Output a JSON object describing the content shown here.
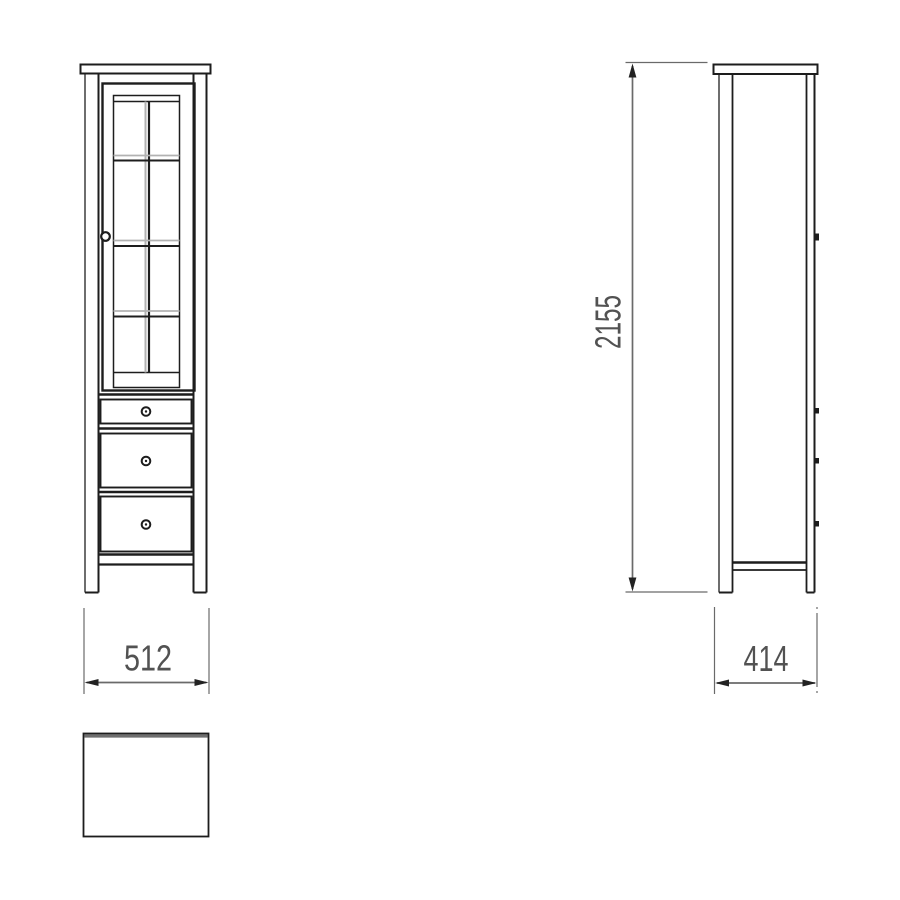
{
  "drawing": {
    "kind": "furniture-orthographic-views",
    "views": {
      "front": {
        "label": "front-view",
        "glass_door_panes": {
          "columns": 2,
          "rows": 4
        },
        "drawers": 3,
        "round_knobs": 4
      },
      "side": {
        "label": "side-view",
        "knob_protrusions": 4
      },
      "top": {
        "label": "top-view-outline"
      }
    }
  },
  "dimensions": {
    "height": {
      "value": "2155",
      "orientation": "vertical"
    },
    "width": {
      "value": "512",
      "orientation": "horizontal"
    },
    "depth": {
      "value": "414",
      "orientation": "horizontal"
    }
  },
  "colors": {
    "background": "#ffffff",
    "line": "#1d1d1d",
    "line_soft": "#6e6e6e",
    "line_light": "#b2b2b2",
    "dimension_line": "#6a6a6a",
    "dimension_text": "#525252"
  }
}
